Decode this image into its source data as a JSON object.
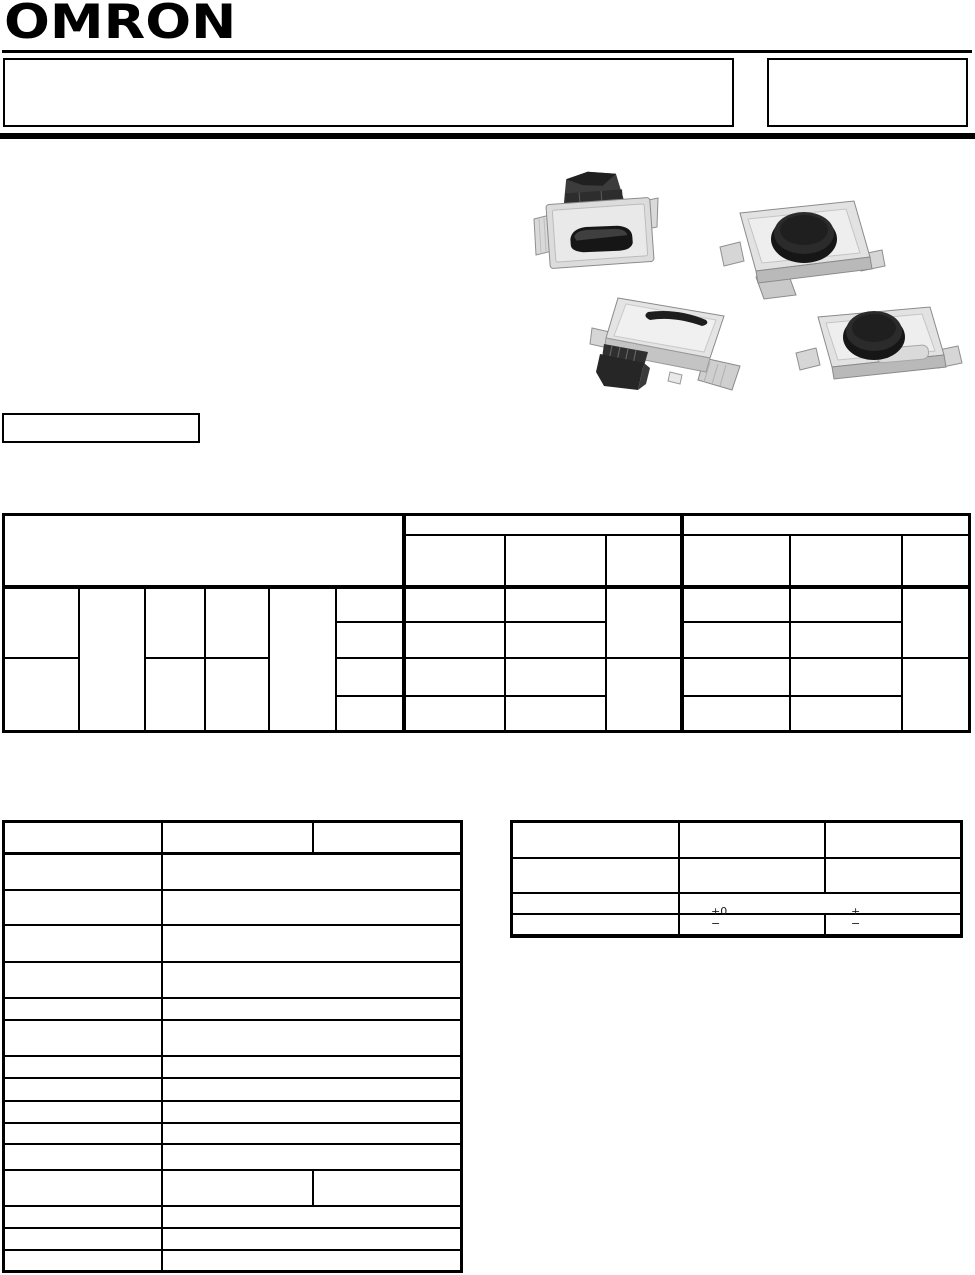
{
  "brand": {
    "logo_text": "OMRON"
  },
  "tables": {
    "packing": {
      "tolerance_left": {
        "top": "+0",
        "bottom": "−"
      },
      "tolerance_right": {
        "top": "+",
        "bottom": "−"
      }
    }
  },
  "colors": {
    "ink": "#000000",
    "paper": "#ffffff",
    "photo_body_gray": "#e2e2e2",
    "photo_edge_gray": "#b9b9b9",
    "photo_button_black": "#161616"
  }
}
